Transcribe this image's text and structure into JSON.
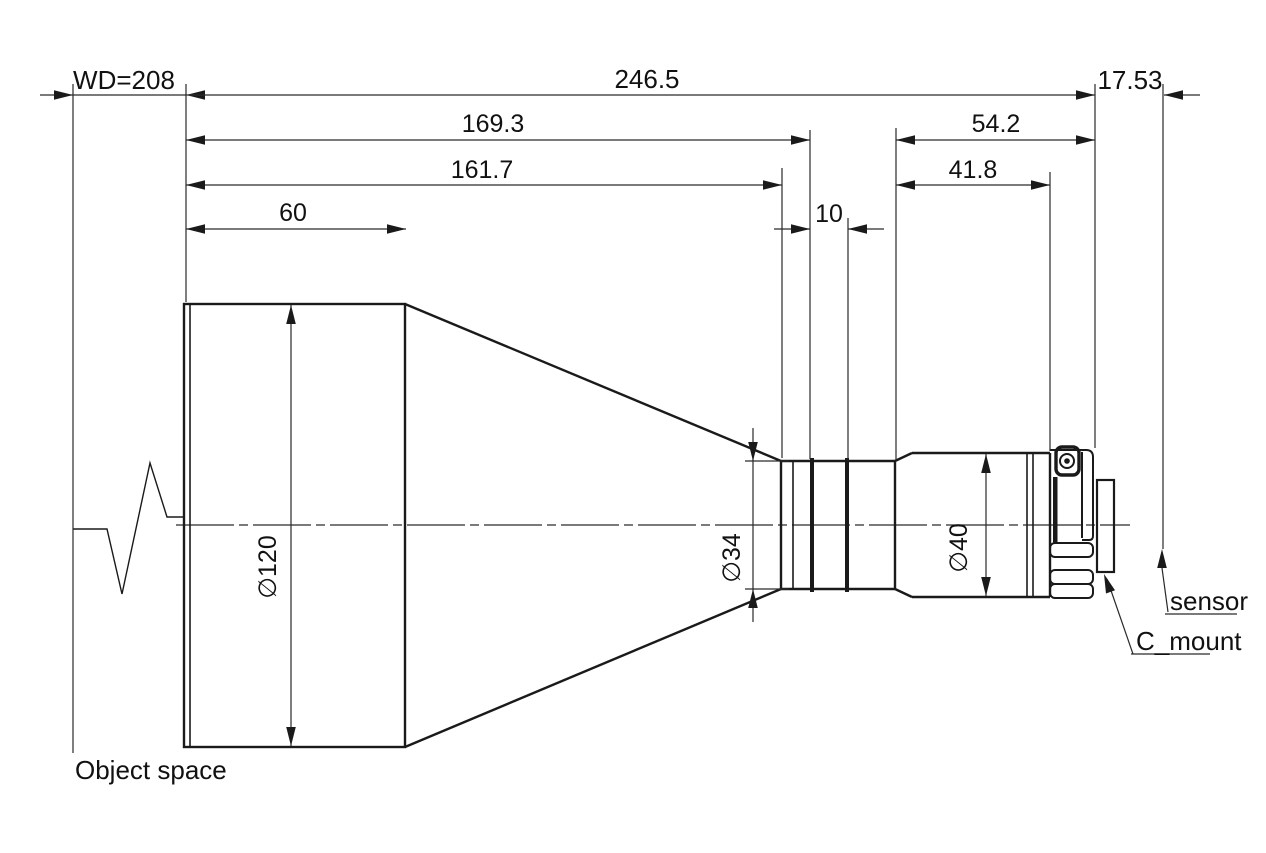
{
  "drawing_type": "lens-mechanical-dimension-drawing",
  "colors": {
    "line": "#1a1a1a",
    "text": "#111111",
    "background": "#ffffff"
  },
  "dimensions": {
    "wd": "WD=208",
    "total_length": "246.5",
    "front_to_stop": "169.3",
    "front_to_tube": "161.7",
    "front_barrel_length": "60",
    "stop_ring_width": "10",
    "rear_assembly_length": "54.2",
    "rear_barrel_length": "41.8",
    "flange_to_sensor": "17.53",
    "front_diameter": "∅120",
    "tube_diameter": "∅34",
    "rear_diameter": "∅40"
  },
  "labels": {
    "object_space": "Object space",
    "sensor": "sensor",
    "c_mount": "C_mount"
  }
}
